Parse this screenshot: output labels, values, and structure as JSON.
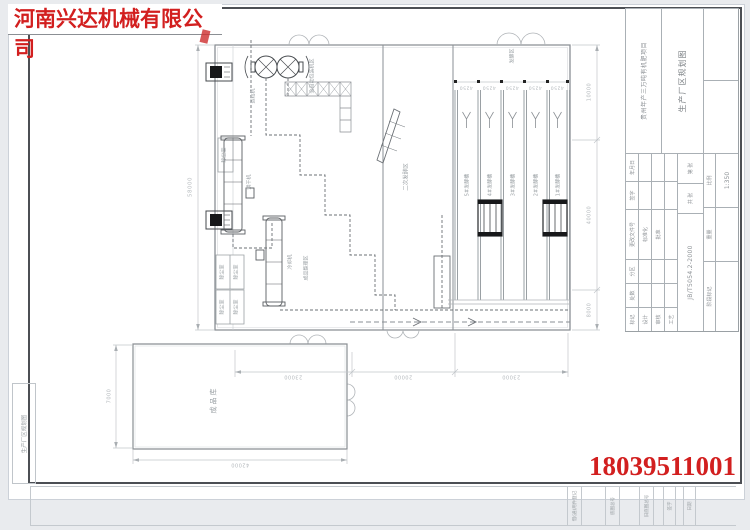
{
  "stamp": {
    "company": "河南兴达机械有限公司",
    "phone": "18039511001"
  },
  "drawing": {
    "rooms": {
      "dust_room": "除尘室",
      "warehouse": "成品库",
      "secondary_fermentation": "二次发酵区",
      "fermentation_zone": "发酵区",
      "finished_area": "成品整理区",
      "packing_area": "全自动包装机区"
    },
    "machines": {
      "dryer": "烘干机",
      "cooler": "冷却机",
      "granulator": "造粒机"
    },
    "troughs": [
      "5#发酵槽",
      "4#发酵槽",
      "3#发酵槽",
      "2#发酵槽",
      "1#发酵槽"
    ],
    "dims": {
      "left_total": "58000",
      "right_top": "10000",
      "right_mid": "40000",
      "right_bot": "8000",
      "bottom_left": "23000",
      "bottom_mid": "20000",
      "bottom_right": "23000",
      "warehouse_w": "42000",
      "warehouse_h": "7000",
      "trough_pitch": "4250"
    }
  },
  "title_block": {
    "project": "贵州年产三万吨有机肥项目",
    "title": "生产厂区规划图",
    "code": "JB/T5054.2-2000",
    "scale_label": "比例",
    "scale_value": "1:350",
    "weight_label": "重量",
    "stage_label": "阶段标记",
    "cols": {
      "mark": "标记",
      "count": "处数",
      "zone": "分区",
      "change_file": "更改文件号",
      "sign": "签字",
      "date": "年月日"
    },
    "roles": {
      "design": "设计",
      "check": "审核",
      "process": "工艺",
      "standard": "标准化",
      "approve": "批准"
    },
    "sheets": {
      "total": "共 张",
      "page": "第 张"
    }
  },
  "margin": {
    "corner_title": "生产厂区规划图",
    "strip": [
      "借(通)用件登记",
      "底图总号",
      "旧底图总号",
      "签字",
      "日期"
    ]
  },
  "colors": {
    "accent_red": "#d21f1f",
    "frame": "#4c4f54",
    "line": "#9aa0a4"
  }
}
